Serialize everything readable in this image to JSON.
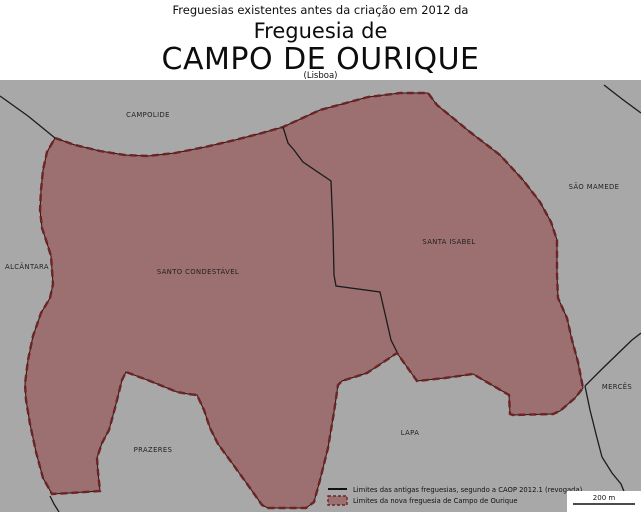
{
  "header": {
    "supertitle": "Freguesias existentes antes da criação em 2012 da",
    "title_line2": "Freguesia de",
    "title_main": "CAMPO DE OURIQUE",
    "subtitle": "(Lisboa)"
  },
  "map": {
    "background_color": "#a8a8a8",
    "region_fill": "#9c7070",
    "region_border_dash": "#6e2424",
    "boundary_line_color": "#1c1c1c",
    "labels": [
      {
        "text": "CAMPOLIDE"
      },
      {
        "text": "SÃO MAMEDE"
      },
      {
        "text": "ALCÂNTARA"
      },
      {
        "text": "SANTO CONDESTÁVEL"
      },
      {
        "text": "SANTA ISABEL"
      },
      {
        "text": "LAPA"
      },
      {
        "text": "MERCÊS"
      },
      {
        "text": "PRAZERES"
      }
    ]
  },
  "legend": {
    "items": [
      {
        "swatch": "old-boundary-line",
        "label": "Limites das antigas freguesias, segundo a CAOP 2012.1 (revogada)"
      },
      {
        "swatch": "new-parish-fill",
        "label": "Limites da nova freguesia de Campo de Ourique"
      }
    ]
  },
  "scalebar": {
    "label": "200 m"
  }
}
